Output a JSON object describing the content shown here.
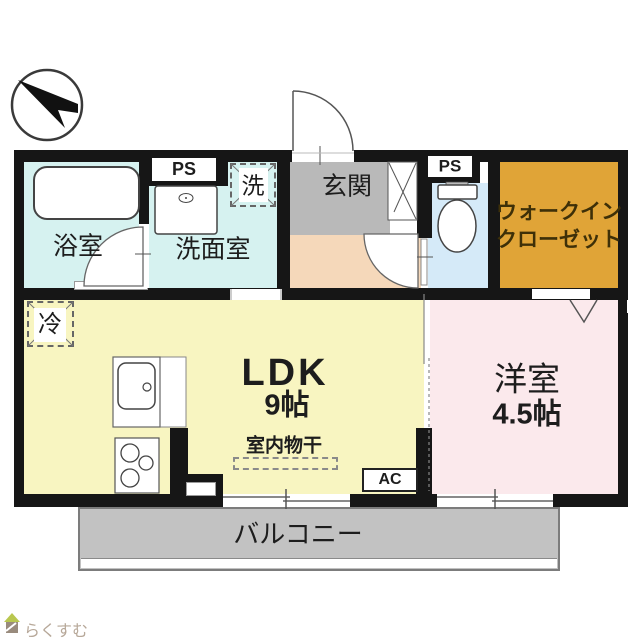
{
  "compass": {
    "description": "north-arrow-pointing-upper-left"
  },
  "rooms": {
    "bathroom": {
      "label": "浴室",
      "color": "#d6f2f0"
    },
    "washroom": {
      "label": "洗面室",
      "color": "#d6f2f0"
    },
    "washing_machine": {
      "label": "洗"
    },
    "pipe_space_top": {
      "label": "PS"
    },
    "pipe_space_right": {
      "label": "PS"
    },
    "entrance": {
      "label": "玄関",
      "color": "#b9b9b9"
    },
    "hallway": {
      "color": "#f5d8ba"
    },
    "toilet": {
      "color": "#d5eaf8"
    },
    "walk_in_closet": {
      "label_line1": "ウォークイン",
      "label_line2": "クローゼット",
      "color": "#e0a437"
    },
    "refrigerator": {
      "label": "冷"
    },
    "ldk": {
      "label": "LDK",
      "size": "9帖",
      "color": "#f8f5c1"
    },
    "indoor_drying": {
      "label": "室内物干"
    },
    "air_conditioner": {
      "label": "AC"
    },
    "western_room": {
      "label": "洋室",
      "size": "4.5帖",
      "color": "#fbe9ec"
    },
    "balcony": {
      "label": "バルコニー",
      "color": "#c2c2c2"
    }
  },
  "branding": {
    "logo_text": "らくすむ"
  },
  "palette": {
    "wall": "#161616",
    "text": "#1d1d1d",
    "wic_text": "#3e3008"
  }
}
